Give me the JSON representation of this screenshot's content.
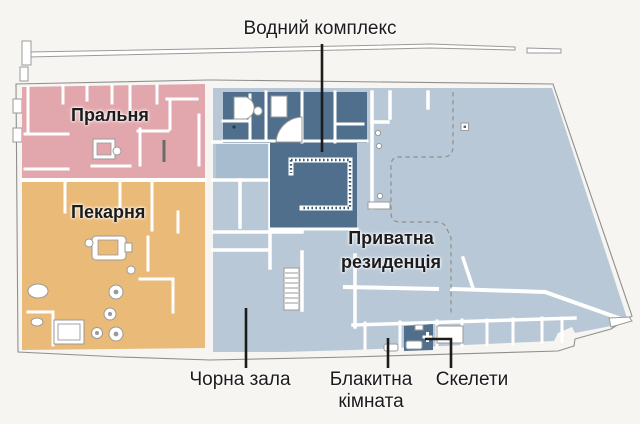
{
  "map": {
    "regions": {
      "water_complex": {
        "label": "Водний комплекс",
        "color": "#4f6f8d"
      },
      "laundry": {
        "label": "Пральня",
        "color": "#e2a7ac"
      },
      "bakery": {
        "label": "Пекарня",
        "color": "#eaba78"
      },
      "private_residence": {
        "label": "Приватна резиденція",
        "color": "#b9c8d7"
      },
      "black_hall": {
        "label": "Чорна зала"
      },
      "blue_room": {
        "label": "Блакитна кімната",
        "color": "#4f6f8d"
      },
      "skeletons": {
        "label": "Скелети"
      }
    },
    "colors": {
      "background": "#f6f5f2",
      "plan_white": "#ffffff",
      "outline": "#8f8f8d",
      "wall_gray": "#9a9a98",
      "laundry_pink": "#e2a7ac",
      "bakery_orange": "#eaba78",
      "light_blue": "#b9c8d7",
      "medium_blue": "#a7bcce",
      "dark_blue": "#4f6f8d",
      "ink": "#1c1c1c"
    }
  }
}
